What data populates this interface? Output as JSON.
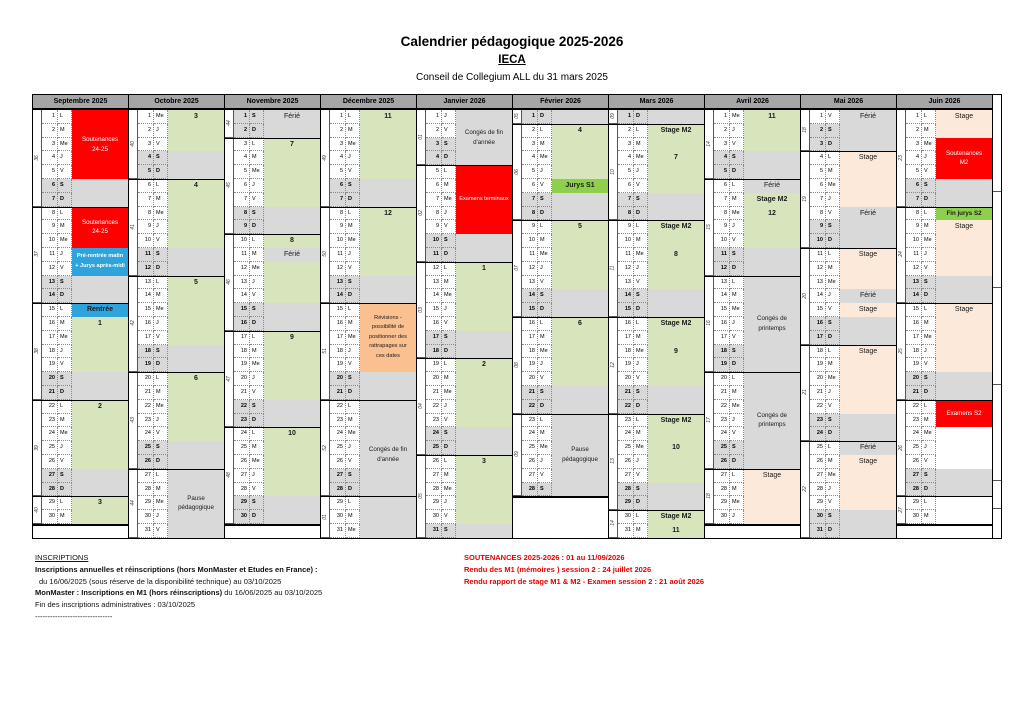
{
  "title": "Calendrier pédagogique 2025-2026",
  "subtitle": "IECA",
  "subsubtitle": "Conseil de Collegium ALL du 31 mars 2025",
  "dow_letters": [
    "L",
    "M",
    "Me",
    "J",
    "V",
    "S",
    "D"
  ],
  "colors": {
    "red": "#ff0000",
    "green": "#d7e4bc",
    "bright_green": "#8ed04e",
    "gray": "#d9d9d9",
    "orange": "#fac090",
    "peach": "#fde9d9",
    "blue": "#2fa3dc",
    "header": "#a6a6a6",
    "weekend": "#d9d9d9",
    "footer_red": "#e60000"
  },
  "months": [
    {
      "name": "Septembre 2025",
      "days": 30,
      "start_dow": 0,
      "weeks": [
        "36",
        "37",
        "38",
        "39",
        "40"
      ],
      "blocks": [
        {
          "from": 1,
          "to": 5,
          "fill": "red",
          "text": "Soutenances\n24-25",
          "text_color": "#ffffff",
          "valign": "center"
        },
        {
          "from": 8,
          "to": 10,
          "fill": "red",
          "text": "Soutenances\n24-25",
          "text_color": "#ffffff",
          "valign": "center"
        },
        {
          "from": 11,
          "to": 12,
          "fill": "blue",
          "text": "Pré-rentrée matin\n+ Jurys après-midi",
          "text_color": "#ffffff",
          "valign": "center",
          "bold": true
        },
        {
          "from": 15,
          "to": 15,
          "fill": "blue",
          "text": "Rentrée",
          "valign": "center",
          "bold": true
        },
        {
          "from": 16,
          "to": 19,
          "fill": "green",
          "text": "1",
          "valign": "top",
          "bold": true
        },
        {
          "from": 22,
          "to": 26,
          "fill": "green",
          "text": "2",
          "valign": "top",
          "bold": true
        },
        {
          "from": 29,
          "to": 30,
          "fill": "green",
          "text": "3",
          "valign": "top",
          "bold": true
        }
      ]
    },
    {
      "name": "Octobre 2025",
      "days": 31,
      "start_dow": 2,
      "weeks": [
        "40",
        "41",
        "42",
        "43",
        "44"
      ],
      "blocks": [
        {
          "from": 1,
          "to": 3,
          "fill": "green",
          "text": "3",
          "valign": "top",
          "bold": true
        },
        {
          "from": 6,
          "to": 10,
          "fill": "green",
          "text": "4",
          "valign": "top",
          "bold": true
        },
        {
          "from": 13,
          "to": 17,
          "fill": "green",
          "text": "5",
          "valign": "top",
          "bold": true
        },
        {
          "from": 20,
          "to": 24,
          "fill": "green",
          "text": "6",
          "valign": "top",
          "bold": true
        },
        {
          "from": 27,
          "to": 31,
          "fill": "gray",
          "text": "Pause\npédagogique",
          "valign": "center"
        }
      ]
    },
    {
      "name": "Novembre 2025",
      "days": 30,
      "start_dow": 5,
      "weeks": [
        "44",
        "45",
        "46",
        "47",
        "48"
      ],
      "blocks": [
        {
          "from": 1,
          "to": 1,
          "fill": "gray",
          "text": "Férié",
          "valign": "center"
        },
        {
          "from": 3,
          "to": 7,
          "fill": "green",
          "text": "7",
          "valign": "top",
          "bold": true
        },
        {
          "from": 10,
          "to": 10,
          "fill": "green",
          "text": "8",
          "valign": "top",
          "bold": true
        },
        {
          "from": 11,
          "to": 11,
          "fill": "gray",
          "text": "Férié",
          "valign": "center"
        },
        {
          "from": 12,
          "to": 14,
          "fill": "green",
          "text": "",
          "valign": "top"
        },
        {
          "from": 17,
          "to": 21,
          "fill": "green",
          "text": "9",
          "valign": "top",
          "bold": true
        },
        {
          "from": 24,
          "to": 28,
          "fill": "green",
          "text": "10",
          "valign": "top",
          "bold": true
        }
      ]
    },
    {
      "name": "Décembre 2025",
      "days": 31,
      "start_dow": 0,
      "weeks": [
        "49",
        "50",
        "51",
        "52",
        "01"
      ],
      "blocks": [
        {
          "from": 1,
          "to": 5,
          "fill": "green",
          "text": "11",
          "valign": "top",
          "bold": true
        },
        {
          "from": 8,
          "to": 12,
          "fill": "green",
          "text": "12",
          "valign": "top",
          "bold": true
        },
        {
          "from": 15,
          "to": 19,
          "fill": "orange",
          "text": "Révisions -\npossibilité de\npositionner des\nrattrapages sur\nces dates",
          "valign": "center"
        },
        {
          "from": 20,
          "to": 31,
          "fill": "gray",
          "text": "Congés de fin\nd'année",
          "valign": "center"
        }
      ]
    },
    {
      "name": "Janvier 2026",
      "days": 31,
      "start_dow": 3,
      "weeks": [
        "01",
        "02",
        "03",
        "04",
        "05"
      ],
      "blocks": [
        {
          "from": 1,
          "to": 4,
          "fill": "gray",
          "text": "Congés de fin\nd'année",
          "valign": "center"
        },
        {
          "from": 5,
          "to": 9,
          "fill": "red",
          "text": "Examens terminaux",
          "text_color": "#ffffff",
          "valign": "center"
        },
        {
          "from": 12,
          "to": 16,
          "fill": "green",
          "text": "1",
          "valign": "top",
          "bold": true
        },
        {
          "from": 19,
          "to": 23,
          "fill": "green",
          "text": "2",
          "valign": "top",
          "bold": true
        },
        {
          "from": 26,
          "to": 30,
          "fill": "green",
          "text": "3",
          "valign": "top",
          "bold": true
        }
      ]
    },
    {
      "name": "Février 2026",
      "days": 28,
      "start_dow": 6,
      "weeks": [
        "05",
        "06",
        "07",
        "08",
        "09"
      ],
      "blocks": [
        {
          "from": 2,
          "to": 5,
          "fill": "green",
          "text": "4",
          "valign": "top",
          "bold": true
        },
        {
          "from": 6,
          "to": 6,
          "fill": "bright_green",
          "text": "Jurys S1",
          "valign": "center",
          "bold": true
        },
        {
          "from": 9,
          "to": 13,
          "fill": "green",
          "text": "5",
          "valign": "top",
          "bold": true
        },
        {
          "from": 16,
          "to": 20,
          "fill": "green",
          "text": "6",
          "valign": "top",
          "bold": true
        },
        {
          "from": 23,
          "to": 28,
          "fill": "gray",
          "text": "Pause\npédagogique",
          "valign": "center"
        }
      ]
    },
    {
      "name": "Mars 2026",
      "days": 31,
      "start_dow": 6,
      "weeks": [
        "09",
        "10",
        "11",
        "12",
        "13",
        "14"
      ],
      "blocks": [
        {
          "from": 2,
          "to": 6,
          "fill": "green",
          "text": "Stage M2\n\n7",
          "valign": "top",
          "bold": true
        },
        {
          "from": 9,
          "to": 13,
          "fill": "green",
          "text": "Stage M2\n\n8",
          "valign": "top",
          "bold": true
        },
        {
          "from": 16,
          "to": 20,
          "fill": "green",
          "text": "Stage M2\n\n9",
          "valign": "top",
          "bold": true
        },
        {
          "from": 23,
          "to": 27,
          "fill": "green",
          "text": "Stage M2\n\n10",
          "valign": "top",
          "bold": true
        },
        {
          "from": 30,
          "to": 31,
          "fill": "green",
          "text": "Stage M2\n11",
          "valign": "top",
          "bold": true
        }
      ]
    },
    {
      "name": "Avril 2026",
      "days": 30,
      "start_dow": 2,
      "weeks": [
        "14",
        "15",
        "16",
        "17",
        "18"
      ],
      "blocks": [
        {
          "from": 1,
          "to": 3,
          "fill": "green",
          "text": "11",
          "valign": "top",
          "bold": true
        },
        {
          "from": 6,
          "to": 6,
          "fill": "gray",
          "text": "Férié",
          "valign": "center"
        },
        {
          "from": 7,
          "to": 10,
          "fill": "green",
          "text": "Stage M2\n12",
          "valign": "top",
          "bold": true
        },
        {
          "from": 13,
          "to": 19,
          "fill": "gray",
          "text": "Congés de\nprintemps",
          "valign": "center"
        },
        {
          "from": 20,
          "to": 26,
          "fill": "gray",
          "text": "Congés de\nprintemps",
          "valign": "center"
        },
        {
          "from": 27,
          "to": 30,
          "fill": "peach",
          "text": "Stage",
          "valign": "top"
        }
      ]
    },
    {
      "name": "Mai 2026",
      "days": 31,
      "start_dow": 4,
      "weeks": [
        "18",
        "19",
        "20",
        "21",
        "22"
      ],
      "blocks": [
        {
          "from": 1,
          "to": 3,
          "fill": "gray",
          "text": "Férié",
          "valign": "top"
        },
        {
          "from": 4,
          "to": 7,
          "fill": "peach",
          "text": "Stage",
          "valign": "top"
        },
        {
          "from": 8,
          "to": 10,
          "fill": "gray",
          "text": "Férié",
          "valign": "top"
        },
        {
          "from": 11,
          "to": 13,
          "fill": "peach",
          "text": "Stage",
          "valign": "top"
        },
        {
          "from": 14,
          "to": 14,
          "fill": "gray",
          "text": "Férié",
          "valign": "center"
        },
        {
          "from": 15,
          "to": 15,
          "fill": "peach",
          "text": "Stage",
          "valign": "center"
        },
        {
          "from": 18,
          "to": 22,
          "fill": "peach",
          "text": "Stage",
          "valign": "top"
        },
        {
          "from": 25,
          "to": 25,
          "fill": "gray",
          "text": "Férié",
          "valign": "center"
        },
        {
          "from": 26,
          "to": 29,
          "fill": "peach",
          "text": "Stage",
          "valign": "top"
        }
      ]
    },
    {
      "name": "Juin 2026",
      "days": 30,
      "start_dow": 0,
      "weeks": [
        "23",
        "24",
        "25",
        "26",
        "27"
      ],
      "blocks": [
        {
          "from": 1,
          "to": 2,
          "fill": "peach",
          "text": "Stage",
          "valign": "top"
        },
        {
          "from": 3,
          "to": 5,
          "fill": "red",
          "text": "Soutenances\nM2",
          "text_color": "#ffffff",
          "valign": "center"
        },
        {
          "from": 8,
          "to": 8,
          "fill": "bright_green",
          "text": "Fin jurys S2",
          "valign": "center",
          "bold": true
        },
        {
          "from": 9,
          "to": 12,
          "fill": "peach",
          "text": "Stage",
          "valign": "top"
        },
        {
          "from": 15,
          "to": 19,
          "fill": "peach",
          "text": "Stage",
          "valign": "top"
        },
        {
          "from": 22,
          "to": 23,
          "fill": "red",
          "text": "Examens S2",
          "text_color": "#ffffff",
          "valign": "center"
        }
      ]
    }
  ],
  "footer_left": {
    "heading": "INSCRIPTIONS",
    "line1": "Inscriptions annuelles et réinscriptions (hors  MonMaster et Etudes en France) :",
    "line2": "du 16/06/2025 (sous réserve de la disponibilité technique) au 03/10/2025",
    "line3_bold": "MonMaster : Inscriptions en M1 (hors réinscriptions)",
    "line3_rest": " du 16/06/2025 au 03/10/2025",
    "line4": "Fin des inscriptions administratives : 03/10/2025",
    "line5": "-------------------------------"
  },
  "footer_right": {
    "line1": "SOUTENANCES 2025-2026 : 01 au 11/09/2026",
    "line2": "Rendu des M1 (mémoires ) session 2 : 24 juillet 2026",
    "line3": "Rendu rapport de stage M1 & M2  - Examen session 2 : 21 août 2026"
  }
}
